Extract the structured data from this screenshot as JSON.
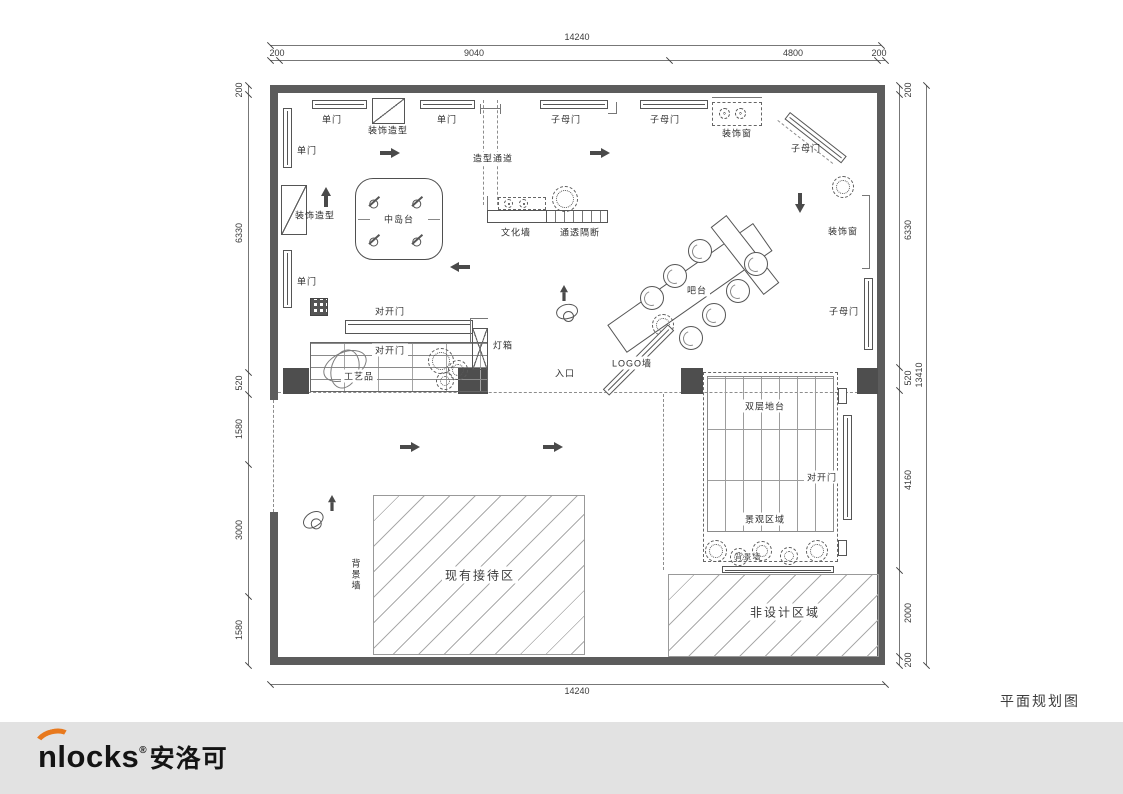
{
  "title": "平面规划图",
  "footer": {
    "brand": "nlocks",
    "reg": "®",
    "brand_cn": "安洛可"
  },
  "colors": {
    "accent": "#e8791d",
    "wall": "#5c5c5c",
    "footer_bar": "#e2e2e2",
    "drawing_line": "#555555"
  },
  "dimensions": {
    "top_total": "14240",
    "top_segments": [
      "200",
      "9040",
      "4800",
      "200"
    ],
    "left_segments": [
      "200",
      "6330",
      "520",
      "1580",
      "3000",
      "1580"
    ],
    "right_segments": [
      "200",
      "6330",
      "520",
      "4160",
      "2000",
      "200"
    ],
    "right_total": "13410",
    "bottom_total": "14240"
  },
  "labels": {
    "door_single_1": "单门",
    "deco_shape_1": "装饰造型",
    "door_single_2": "单门",
    "door_zimu_1": "子母门",
    "door_zimu_2": "子母门",
    "deco_window_1": "装饰窗",
    "door_zimu_3": "子母门",
    "door_single_left_1": "单门",
    "passage": "造型通道",
    "deco_shape_2": "装饰造型",
    "island": "中岛台",
    "culture_wall": "文化墙",
    "partition": "通透隔断",
    "deco_window_2": "装饰窗",
    "bar": "吧台",
    "door_zimu_4": "子母门",
    "door_single_left_2": "单门",
    "door_double_1": "对开门",
    "door_double_2": "对开门",
    "lightbox": "灯箱",
    "logo_wall": "LOGO墙",
    "crafts": "工艺品",
    "entrance": "入口",
    "platform": "双层地台",
    "door_double_3": "对开门",
    "landscape_area": "景观区域",
    "bg_wall_plants": "背景墙",
    "bg_wall_left": "背景墙",
    "reception": "现有接待区",
    "non_design": "非设计区域"
  }
}
